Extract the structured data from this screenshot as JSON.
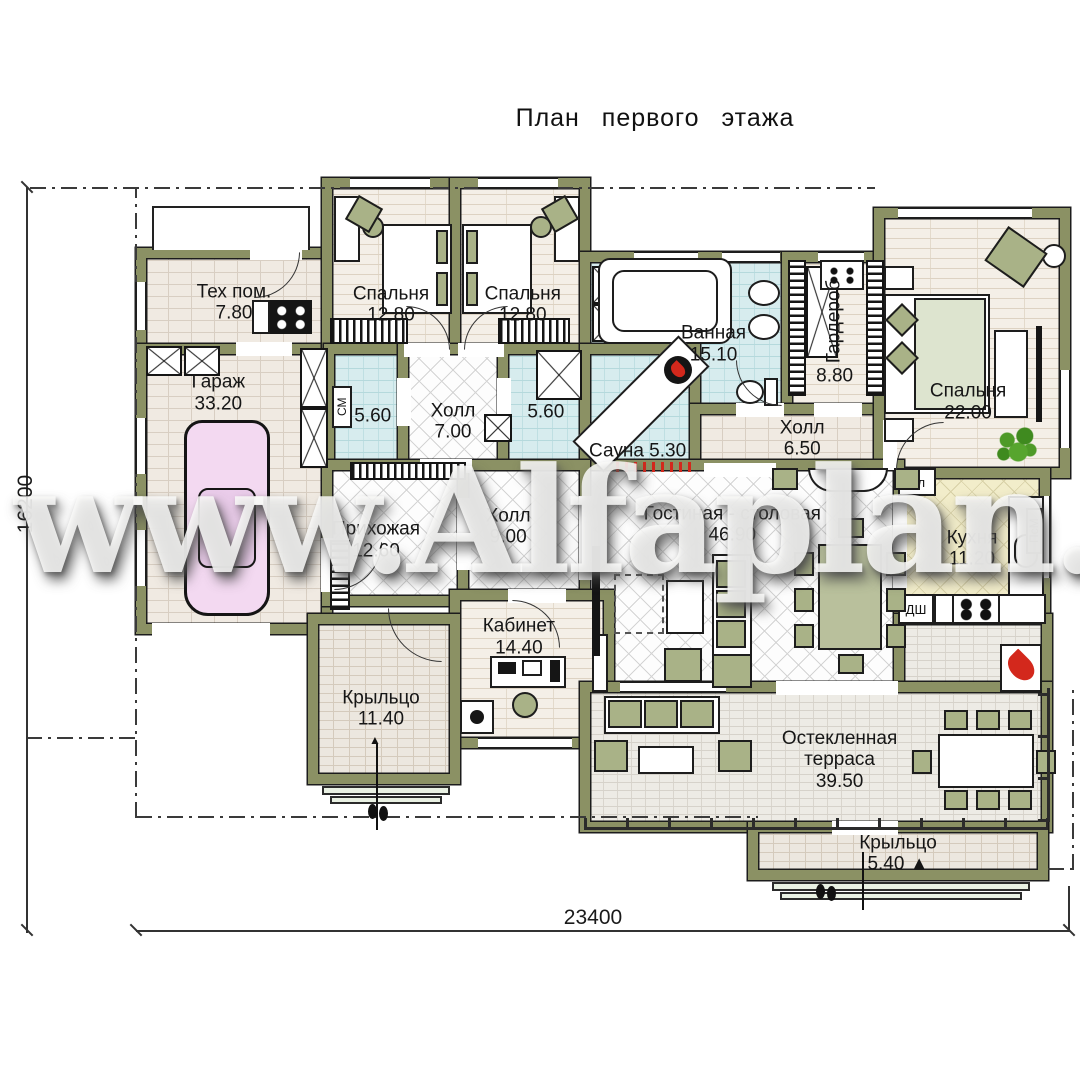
{
  "title": "План первого этажа",
  "watermark": "www.Alfaplan.ru",
  "dimensions": {
    "bottom": "23400",
    "left": "16200"
  },
  "icons": {
    "entrance_marker": "▲"
  },
  "appliances": {
    "fridge": "Хл",
    "washer": "СМ",
    "oven": "ДШ",
    "dishwasher": "ПсМ"
  },
  "colors": {
    "wall": "#8b9164",
    "wet_floor": "#d7ecee",
    "kitchen_floor": "#f2edca",
    "car": "#f3d9f1",
    "accent_red": "#d3281c",
    "plant_green": "#4e9a28"
  },
  "rooms": [
    {
      "id": "tech",
      "name": "Тех пом.",
      "area": "7.80",
      "floor": "brick",
      "bbox": [
        136,
        248,
        196,
        106
      ],
      "lx": 0.5,
      "ly": 0.52
    },
    {
      "id": "garage",
      "name": "Гараж",
      "area": "33.20",
      "floor": "brick",
      "bbox": [
        136,
        344,
        196,
        290
      ],
      "lx": 0.42,
      "ly": 0.17
    },
    {
      "id": "bedroom1",
      "name": "Спальня",
      "area": "12.80",
      "floor": "plank",
      "bbox": [
        322,
        178,
        138,
        176
      ],
      "lx": 0.5,
      "ly": 0.72
    },
    {
      "id": "bedroom2",
      "name": "Спальня",
      "area": "12.80",
      "floor": "plank",
      "bbox": [
        450,
        178,
        140,
        176
      ],
      "lx": 0.52,
      "ly": 0.72
    },
    {
      "id": "laundry",
      "name": "",
      "area": "5.60",
      "floor": "wet",
      "bbox": [
        324,
        344,
        84,
        130
      ],
      "lx": 0.58,
      "ly": 0.55
    },
    {
      "id": "hall7",
      "name": "Холл",
      "area": "7.00",
      "floor": "diamond",
      "bbox": [
        398,
        344,
        110,
        126
      ],
      "lx": 0.5,
      "ly": 0.62
    },
    {
      "id": "bath560",
      "name": "",
      "area": "5.60",
      "floor": "wet",
      "bbox": [
        498,
        344,
        92,
        130
      ],
      "lx": 0.52,
      "ly": 0.52
    },
    {
      "id": "bathroom",
      "name": "Ванная",
      "area": "15.10",
      "floor": "wet",
      "bbox": [
        580,
        252,
        212,
        162
      ],
      "lx": 0.63,
      "ly": 0.57
    },
    {
      "id": "wardrobe",
      "name": "Гардероб",
      "area": "8.80",
      "floor": "plank",
      "bbox": [
        782,
        252,
        112,
        162
      ],
      "lx": 0.47,
      "ly": 0.5,
      "vertical": true
    },
    {
      "id": "sauna",
      "name": "Сауна",
      "area": "5.30",
      "floor": "wet",
      "bbox": [
        580,
        344,
        120,
        130
      ],
      "lx": 0.48,
      "ly": 0.82,
      "inline": true
    },
    {
      "id": "hall65",
      "name": "Холл",
      "area": "6.50",
      "floor": "brick",
      "bbox": [
        690,
        404,
        204,
        70
      ],
      "lx": 0.55,
      "ly": 0.5,
      "inlineWide": false
    },
    {
      "id": "bedroom3",
      "name": "Спальня",
      "area": "22.00",
      "floor": "plank",
      "bbox": [
        874,
        208,
        196,
        270
      ],
      "lx": 0.48,
      "ly": 0.72
    },
    {
      "id": "kitchen",
      "name": "Кухня",
      "area": "11.20",
      "floor": "kitchen",
      "bbox": [
        894,
        468,
        156,
        156
      ],
      "lx": 0.5,
      "ly": 0.52
    },
    {
      "id": "living",
      "name": "Гостиная - столовая",
      "area": "46.90",
      "floor": "diamond",
      "bbox": [
        580,
        460,
        324,
        232
      ],
      "lx": 0.47,
      "ly": 0.28
    },
    {
      "id": "entry",
      "name": "Прихожая",
      "area": "12.60",
      "floor": "diamond",
      "bbox": [
        322,
        460,
        146,
        146
      ],
      "lx": 0.37,
      "ly": 0.55
    },
    {
      "id": "hall9",
      "name": "Холл",
      "area": "9.00",
      "floor": "diamond",
      "bbox": [
        458,
        460,
        132,
        140
      ],
      "lx": 0.38,
      "ly": 0.48
    },
    {
      "id": "office",
      "name": "Кабинет",
      "area": "14.40",
      "floor": "plank",
      "bbox": [
        450,
        590,
        164,
        158
      ],
      "lx": 0.42,
      "ly": 0.3
    },
    {
      "id": "porch_left",
      "name": "Крыльцо",
      "area": "11.40",
      "floor": "porch",
      "bbox": [
        308,
        614,
        152,
        170
      ],
      "lx": 0.48,
      "ly": 0.56
    },
    {
      "id": "terrace_ext",
      "name": "",
      "area": "",
      "floor": "terrace",
      "bbox": [
        894,
        614,
        158,
        88
      ]
    },
    {
      "id": "terrace",
      "name": "Остекленная терраса",
      "area": "39.50",
      "floor": "terrace",
      "bbox": [
        580,
        682,
        472,
        150
      ],
      "lx": 0.55,
      "ly": 0.52,
      "wrap": true
    },
    {
      "id": "porch_bottom",
      "name": "Крыльцо",
      "area": "5.40",
      "floor": "porch",
      "bbox": [
        748,
        822,
        300,
        58
      ],
      "lx": 0.5,
      "ly": 0.55,
      "suffix": "entrance_marker"
    }
  ]
}
